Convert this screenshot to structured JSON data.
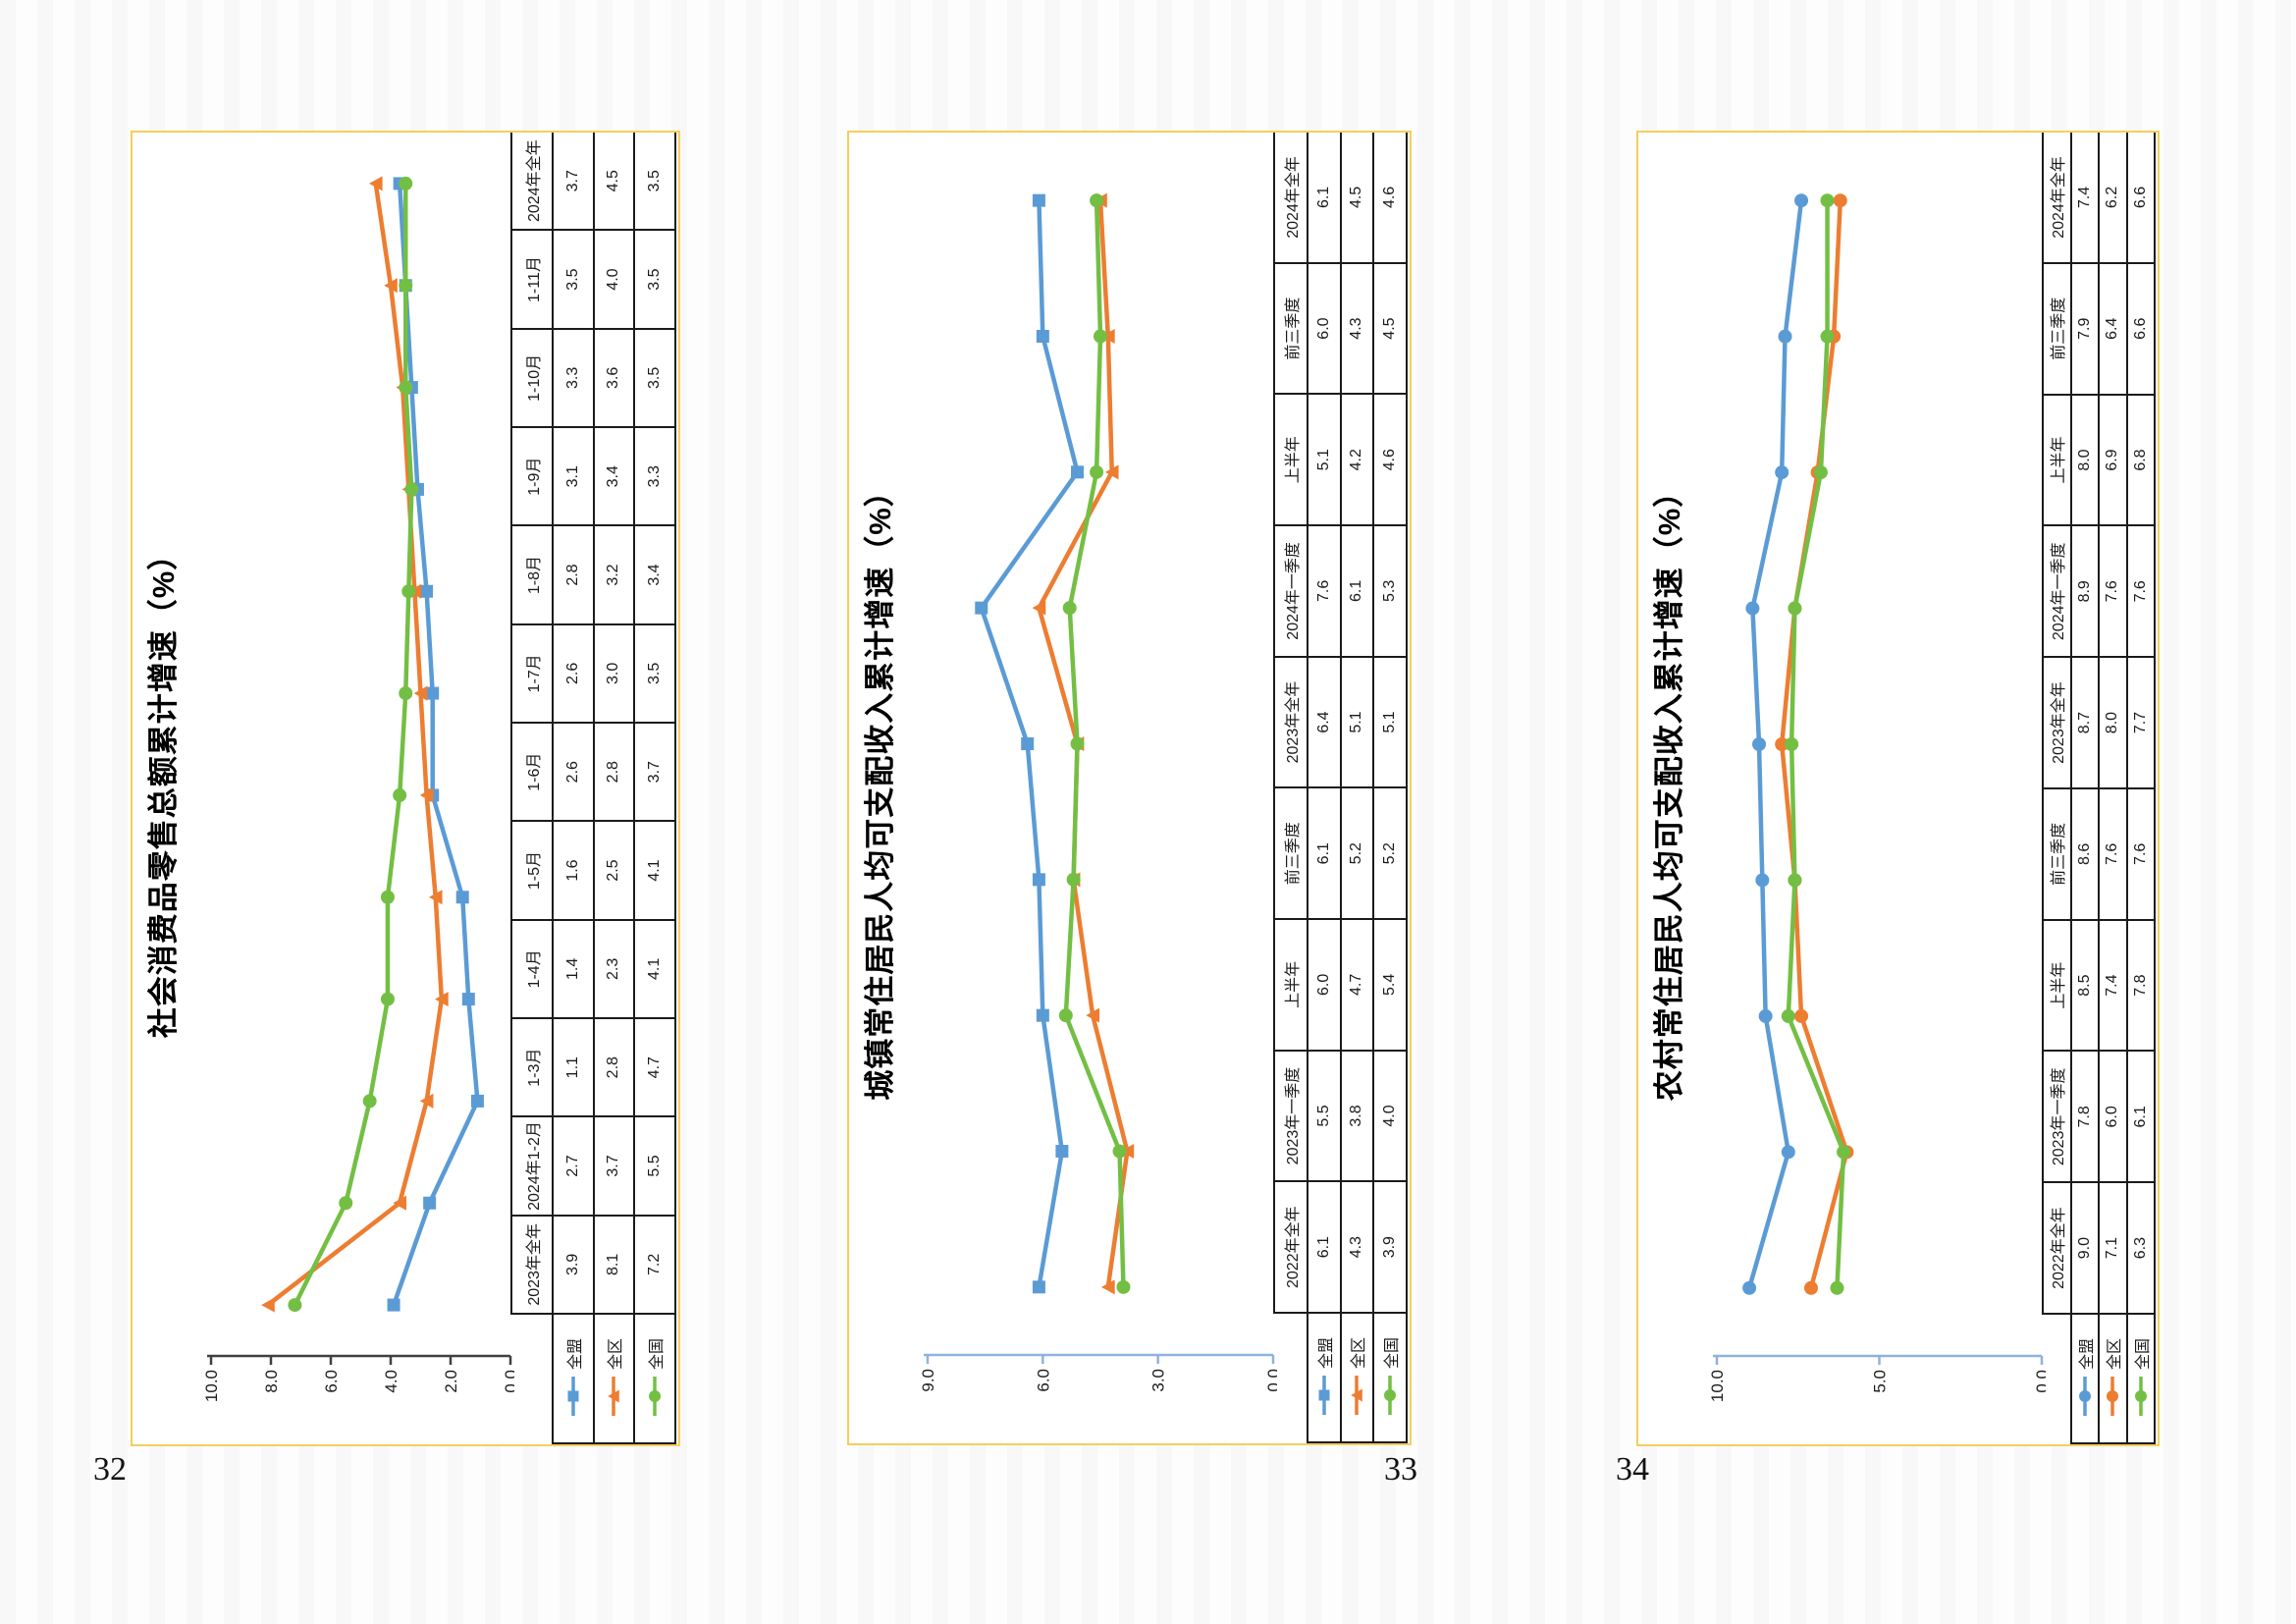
{
  "page": {
    "numbers": [
      "32",
      "33",
      "34"
    ],
    "panel_border_color": "#F3CF5D"
  },
  "chart_data": [
    {
      "type": "line",
      "title": "社会消费品零售总额累计增速（%）",
      "xlabel": "",
      "ylabel": "",
      "ylim": [
        0,
        10
      ],
      "y_ticks": [
        "10.0",
        "8.0",
        "6.0",
        "4.0",
        "2.0",
        "0.0"
      ],
      "axis_color": "#404040",
      "grid": false,
      "legend_position": "data-table-left",
      "categories": [
        "2023年全年",
        "2024年1-2月",
        "1-3月",
        "1-4月",
        "1-5月",
        "1-6月",
        "1-7月",
        "1-8月",
        "1-9月",
        "1-10月",
        "1-11月",
        "2024年全年"
      ],
      "series": [
        {
          "name": "全盟",
          "color": "#5B9BD5",
          "marker": "square",
          "values": [
            "3.9",
            "2.7",
            "1.1",
            "1.4",
            "1.6",
            "2.6",
            "2.6",
            "2.8",
            "3.1",
            "3.3",
            "3.5",
            "3.7"
          ]
        },
        {
          "name": "全区",
          "color": "#ED7D31",
          "marker": "triangle",
          "values": [
            "8.1",
            "3.7",
            "2.8",
            "2.3",
            "2.5",
            "2.8",
            "3.0",
            "3.2",
            "3.4",
            "3.6",
            "4.0",
            "4.5"
          ]
        },
        {
          "name": "全国",
          "color": "#73BF44",
          "marker": "circle",
          "values": [
            "7.2",
            "5.5",
            "4.7",
            "4.1",
            "4.1",
            "3.7",
            "3.5",
            "3.4",
            "3.3",
            "3.5",
            "3.5",
            "3.5"
          ]
        }
      ]
    },
    {
      "type": "line",
      "title": "城镇常住居民人均可支配收入累计增速（%）",
      "xlabel": "",
      "ylabel": "",
      "ylim": [
        0,
        9
      ],
      "y_ticks": [
        "9.0",
        "6.0",
        "3.0",
        "0.0"
      ],
      "axis_color": "#8FB2DE",
      "grid": false,
      "legend_position": "data-table-left",
      "categories": [
        "2022年全年",
        "2023年一季度",
        "上半年",
        "前三季度",
        "2023年全年",
        "2024年一季度",
        "上半年",
        "前三季度",
        "2024年全年"
      ],
      "series": [
        {
          "name": "全盟",
          "color": "#5B9BD5",
          "marker": "square",
          "values": [
            "6.1",
            "5.5",
            "6.0",
            "6.1",
            "6.4",
            "7.6",
            "5.1",
            "6.0",
            "6.1"
          ]
        },
        {
          "name": "全区",
          "color": "#ED7D31",
          "marker": "triangle",
          "values": [
            "4.3",
            "3.8",
            "4.7",
            "5.2",
            "5.1",
            "6.1",
            "4.2",
            "4.3",
            "4.5"
          ]
        },
        {
          "name": "全国",
          "color": "#73BF44",
          "marker": "circle",
          "values": [
            "3.9",
            "4.0",
            "5.4",
            "5.2",
            "5.1",
            "5.3",
            "4.6",
            "4.5",
            "4.6"
          ]
        }
      ]
    },
    {
      "type": "line",
      "title": "农村常住居民人均可支配收入累计增速（%）",
      "xlabel": "",
      "ylabel": "",
      "ylim": [
        0,
        10
      ],
      "y_ticks": [
        "10.0",
        "5.0",
        "0.0"
      ],
      "axis_color": "#8FB2DE",
      "grid": false,
      "legend_position": "data-table-left",
      "categories": [
        "2022年全年",
        "2023年一季度",
        "上半年",
        "前三季度",
        "2023年全年",
        "2024年一季度",
        "上半年",
        "前三季度",
        "2024年全年"
      ],
      "series": [
        {
          "name": "全盟",
          "color": "#5B9BD5",
          "marker": "circle",
          "values": [
            "9.0",
            "7.8",
            "8.5",
            "8.6",
            "8.7",
            "8.9",
            "8.0",
            "7.9",
            "7.4"
          ]
        },
        {
          "name": "全区",
          "color": "#ED7D31",
          "marker": "circle",
          "values": [
            "7.1",
            "6.0",
            "7.4",
            "7.6",
            "8.0",
            "7.6",
            "6.9",
            "6.4",
            "6.2"
          ]
        },
        {
          "name": "全国",
          "color": "#73BF44",
          "marker": "circle",
          "values": [
            "6.3",
            "6.1",
            "7.8",
            "7.6",
            "7.7",
            "7.6",
            "6.8",
            "6.6",
            "6.6"
          ]
        }
      ]
    }
  ]
}
